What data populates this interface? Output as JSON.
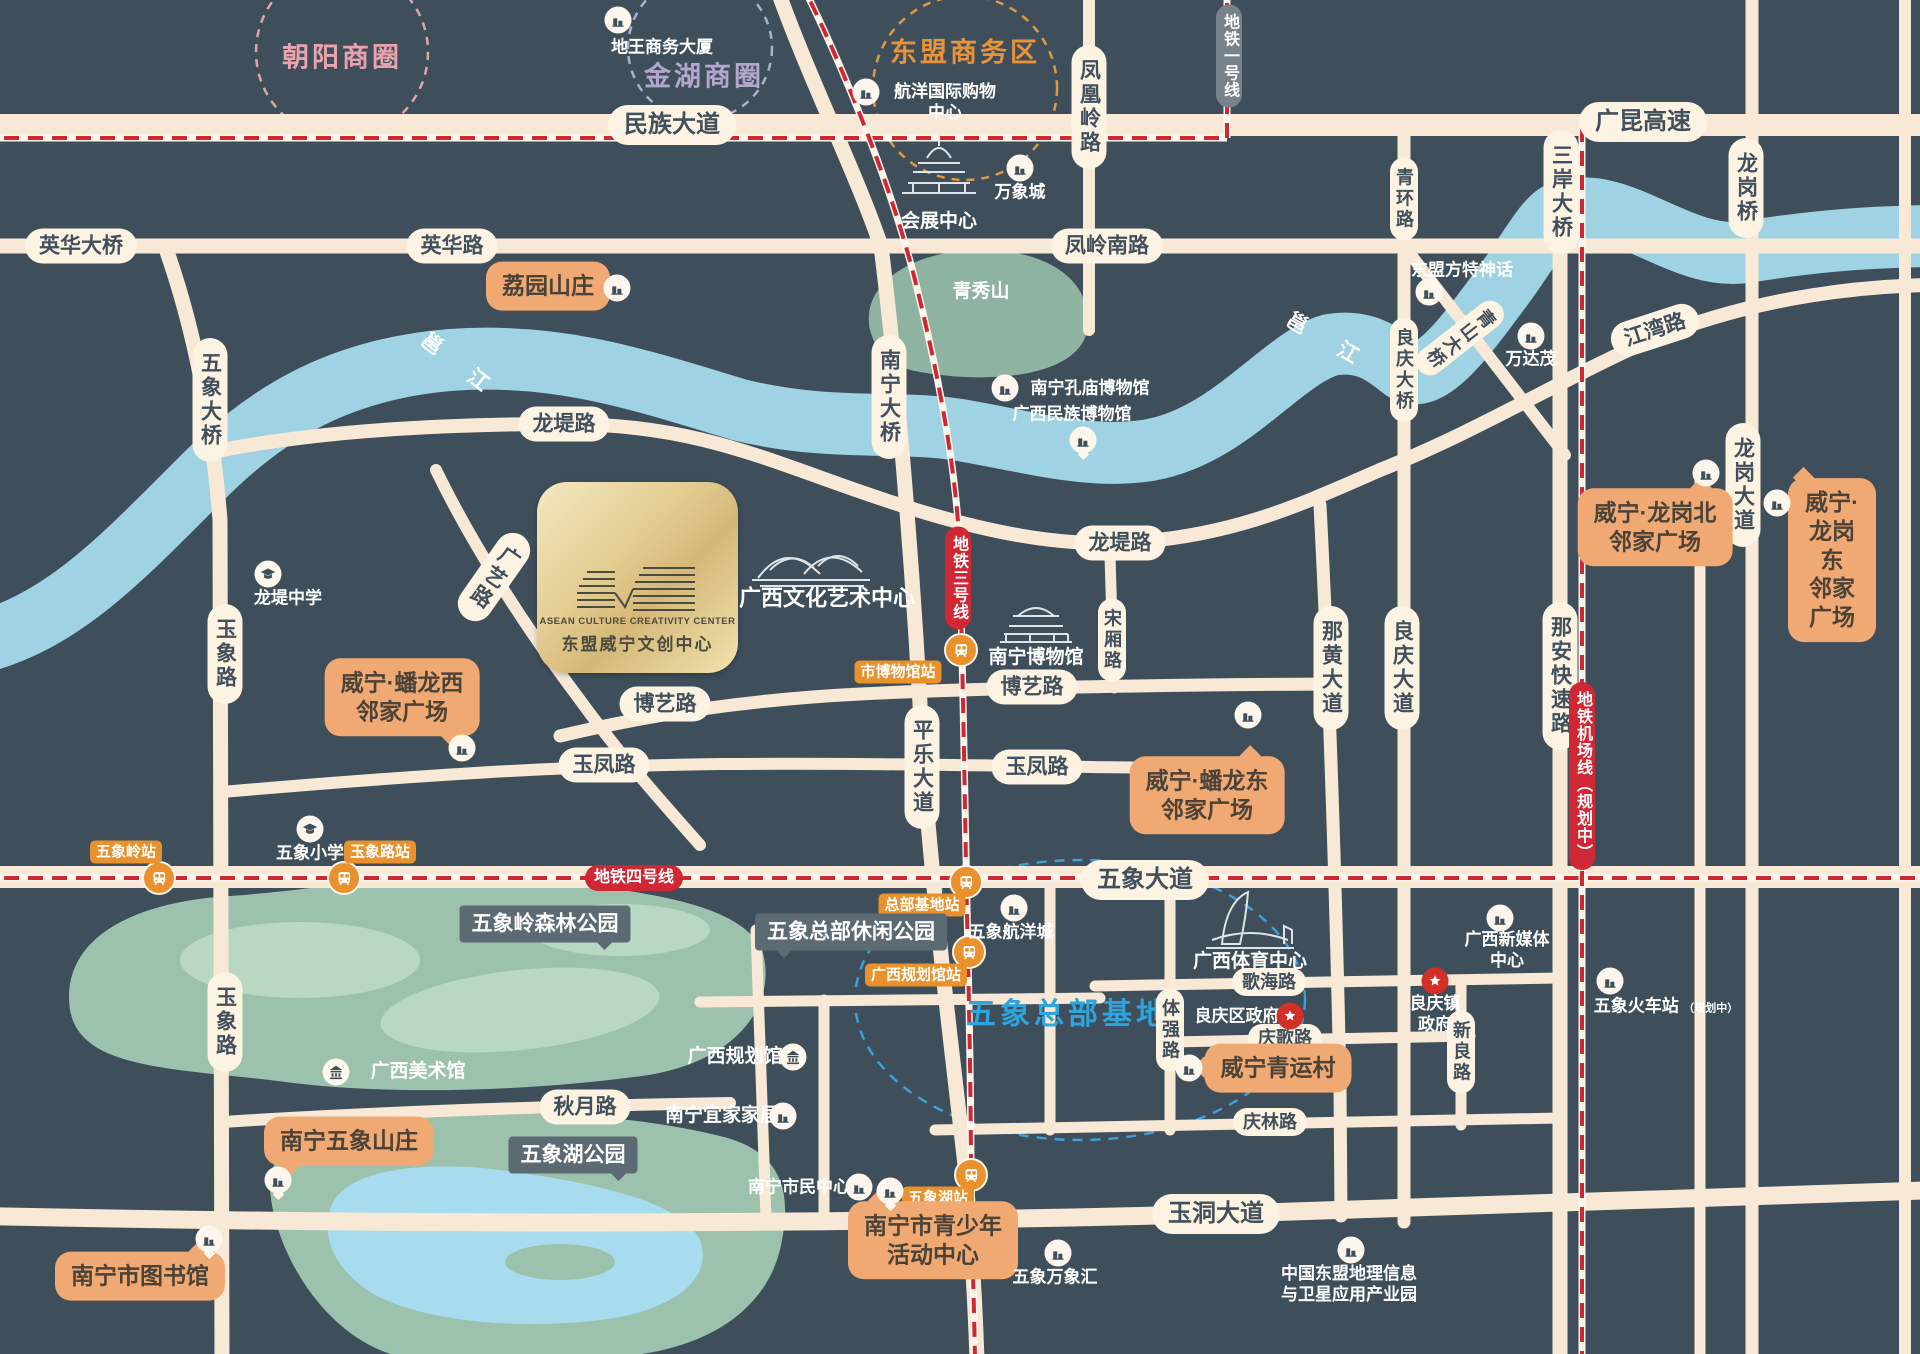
{
  "districts": {
    "chaoyang": "朝阳商圈",
    "jinhu": "金湖商圈",
    "asean_biz": "东盟商务区",
    "wuxiang_hq": "五象总部基地"
  },
  "project": {
    "logo_en": "ASEAN CULTURE CREATIVITY CENTER",
    "logo_cn": "东盟威宁文创中心"
  },
  "roads": {
    "minzu": "民族大道",
    "guangkun": "广昆高速",
    "yinghua_bridge": "英华大桥",
    "yinghua": "英华路",
    "fengling_south": "凤岭南路",
    "fenghuangling": "凤凰岭路",
    "jiangwan": "江湾路",
    "longdi": "龙堤路",
    "boyi": "博艺路",
    "yufeng": "玉凤路",
    "wuxiang_ave": "五象大道",
    "qiuyue": "秋月路",
    "yudong": "玉洞大道",
    "gehai": "歌海路",
    "qingge": "庆歌路",
    "qinglin": "庆林路",
    "wuxiang_bridge": "五象大桥",
    "yuxiang": "玉象路",
    "guangyi": "广艺路",
    "pingle": "平乐大道",
    "nanning_bridge": "南宁大桥",
    "songxiang": "宋厢路",
    "tiqiang": "体强路",
    "nahuang": "那黄大道",
    "qinghuan": "青环路",
    "liangqing_bridge": "良庆大桥",
    "liangqing_ave": "良庆大道",
    "sanan_bridge": "三岸大桥",
    "naan_express": "那安快速路",
    "longgang_bridge": "龙岗桥",
    "longgang_ave": "龙岗大道",
    "xinliang": "新良路",
    "qingshan_bridge": "青山大桥"
  },
  "metro": {
    "line1": "地铁一号线",
    "line3": "地铁三号线",
    "line4": "地铁四号线",
    "airport": "地铁机场线（规划中）"
  },
  "stations": {
    "wuxiangling": "五象岭站",
    "yuxianglu": "玉象路站",
    "museum": "市博物馆站",
    "hq_base": "总部基地站",
    "planning_hall": "广西规划馆站",
    "wuxiang_lake": "五象湖站"
  },
  "river_label": "邕 江",
  "pois": {
    "diwang": "地王商务大厦",
    "hangyang": "航洋国际购物\n中心",
    "wanxiang_city": "万象城",
    "convention": "会展中心",
    "qingxiushan": "青秀山",
    "fangte": "东盟方特神话",
    "wandamao": "万达茂",
    "kongmiao": "南宁孔庙博物馆",
    "minzu_museum": "广西民族博物馆",
    "longdi_school": "龙堤中学",
    "wuxiang_school": "五象小学",
    "nanning_museum": "南宁博物馆",
    "art_center": "广西文化艺术中心",
    "wuxiang_hangyang": "五象航洋城",
    "sports_center": "广西体育中心",
    "liangqing_gov": "良庆区政府",
    "town_gov": "良庆镇\n政府",
    "new_media": "广西新媒体\n中心",
    "rail_station": "五象火车站",
    "rail_note": "（规划中）",
    "planning_hall": "广西规划馆",
    "ikea": "南宁宜家家居",
    "fine_arts": "广西美术馆",
    "citizen_center": "南宁市民中心",
    "wuxiang_mixc": "五象万象汇",
    "geo_park": "中国东盟地理信息\n与卫星应用产业园",
    "forest_park": "五象岭森林公园",
    "hq_leisure_park": "五象总部休闲公园",
    "lake_park": "五象湖公园"
  },
  "callouts": {
    "liyuan": "荔园山庄",
    "panlong_west": "威宁·蟠龙西\n邻家广场",
    "panlong_east": "威宁·蟠龙东\n邻家广场",
    "longgang_north": "威宁·龙岗北\n邻家广场",
    "longgang_east": "威宁·龙岗东\n邻家广场",
    "qingyun": "威宁青运村",
    "villa": "南宁五象山庄",
    "library": "南宁市图书馆",
    "youth": "南宁市青少年\n活动中心"
  },
  "colors": {
    "background": "#3e4e5a",
    "road": "#f7e9d5",
    "river": "#9fd2e3",
    "park": "#9cc2ad",
    "lake": "#a6dcee",
    "metro_red": "#cf2733",
    "station_orange": "#e8912d",
    "callout_orange": "#f0a973",
    "hq_blue": "#2fa3dc",
    "gold": "#d5b878"
  }
}
